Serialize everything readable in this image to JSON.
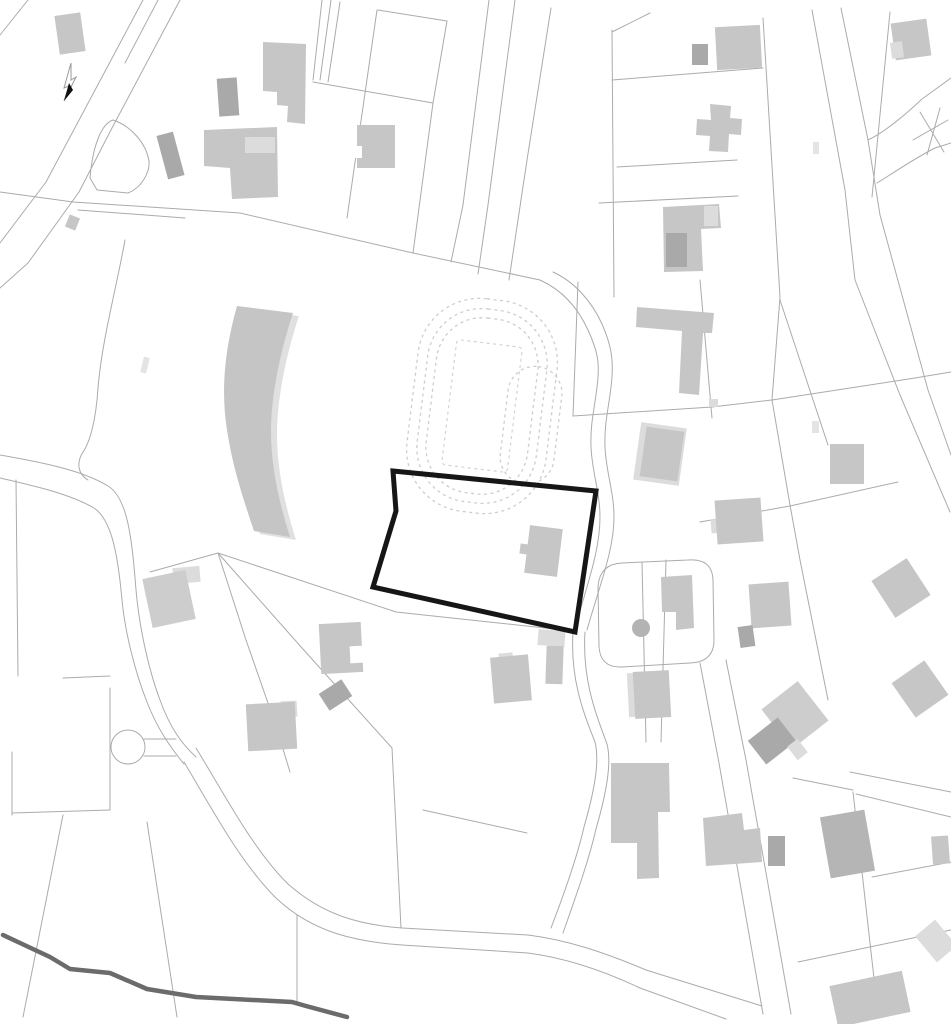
{
  "map": {
    "canvas": {
      "width": 951,
      "height": 1024,
      "background": "#ffffff"
    },
    "palette": {
      "mid": "#c6c6c6",
      "mid2": "#cdcdcd",
      "dim": "#b5b5b5",
      "dark": "#a9a9a9",
      "light": "#dcdcdc",
      "lighter": "#e4e4e4",
      "white": "#ffffff",
      "line": "#ababab",
      "track_dash": "#cdcdcd",
      "site_outline": "#161616",
      "stream": "#6b6b6b",
      "band_fill": "#c5c5c5",
      "band_halo": "#e0e0e0",
      "dot_fill": "#b3b3b3"
    },
    "site_boundary": {
      "points": "393,471 596,491 575,632 373,587 396,511",
      "stroke_width": 5
    },
    "stream": {
      "d": "M3,935 L50,957 L70,969 L110,973 L147,989 L196,997 L292,1002 L306,1006 L347,1017",
      "stroke_width": 4.5
    },
    "north_arrow": {
      "outline_points": "71,63 64,88 69,86 64,101 76,77 71,80",
      "blade_points": "64,101 69,83 73,90"
    },
    "pond": {
      "d": "M90,178 C93,142 103,123 113,120 C131,126 146,143 149,161 C150,173 141,188 128,193 L97,190 Z"
    },
    "culdesac": {
      "cx": 128,
      "cy": 747,
      "r": 17,
      "stubs": [
        "M144,739 L176,739",
        "M144,756 L176,756"
      ]
    },
    "dot": {
      "cx": 641,
      "cy": 628,
      "r": 9
    },
    "band": {
      "halo_dx": 6,
      "halo_dy": 3,
      "d": "M237,306 C224,352 221,392 227,430 C233,470 245,504 254,531 L290,537 C279,502 271,467 271,431 C271,396 280,352 293,313 Z"
    },
    "track": {
      "cx": 482,
      "cy": 406,
      "rot": 7,
      "rings": [
        {
          "w": 140,
          "h": 214,
          "rx": 62
        },
        {
          "w": 120,
          "h": 194,
          "rx": 54
        },
        {
          "w": 102,
          "h": 176,
          "rx": 46
        }
      ],
      "field": {
        "w": 66,
        "h": 126,
        "rx": 4
      },
      "appendix": {
        "x": 24,
        "y": -46,
        "w": 54,
        "h": 118,
        "rx": 27
      }
    },
    "lines": [
      "M143,0 L110,62 L78,122 L46,182 L0,243",
      "M180,0 L146,64 L112,128 L79,192 L28,263 L0,288",
      "M158,0 L125,63",
      "M28,0 L0,35",
      "M0,192 L73,202 L240,213 L413,253 L540,280",
      "M78,210 L185,218",
      "M540,280 C562,290 578,308 588,330 C598,352 599,362 598,377 C596,404 590,420 591,447 C592,472 600,492 600,517 C600,550 588,582 575,628",
      "M553,272 C575,282 592,302 602,324 C612,347 613,360 612,377 C610,404 604,420 605,447 C606,472 614,492 614,517 C614,550 600,584 587,630",
      "M573,632 C570,680 584,714 595,742 C600,762 594,792 584,827 C576,862 561,902 551,928",
      "M585,632 C582,680 596,714 607,744 C612,764 606,794 596,829 C588,864 573,904 563,933",
      "M489,0 L463,205 L451,262",
      "M515,0 L488,205 L478,274",
      "M551,8 L527,160 L509,280",
      "M313,82 L433,103",
      "M378,10 L447,21",
      "M377,10 L347,218",
      "M322,0 L313,80",
      "M331,0 L320,80",
      "M340,2 L328,82",
      "M433,103 L413,253",
      "M447,21 L440,62 L433,103",
      "M16,480 L18,676",
      "M12,752 L12,815",
      "M12,813 L110,810",
      "M110,688 L110,810",
      "M63,678 L110,676",
      "M0,455 C40,462 82,470 108,486 C128,498 132,540 136,590 C139,625 148,668 160,700 C170,728 182,744 196,757",
      "M0,478 C35,486 70,494 94,508 C112,520 118,556 122,600 C125,632 135,672 147,702 C157,728 170,747 184,764",
      "M196,748 C225,795 252,848 288,884 C324,916 362,925 402,928 L528,935 C568,940 606,953 646,970 L762,1006",
      "M184,762 C214,812 240,862 276,898 C314,934 360,942 402,945 L528,953 C566,958 602,970 640,988 L726,1019",
      "M700,663 L719,763 L763,1014",
      "M726,660 L746,760 L791,1014",
      "M598,586 Q600,564 622,563 L688,560 Q712,558 713,580 L714,640 Q714,662 690,663 L622,667 Q600,668 599,646 Z",
      "M642,562 L646,742",
      "M666,560 L661,742",
      "M612,30 L614,297",
      "M612,32 L650,13",
      "M612,80 L763,68",
      "M617,167 L737,160",
      "M599,203 L738,196",
      "M763,18 L780,297",
      "M700,280 L712,418",
      "M578,282 L573,416",
      "M573,416 L712,407 L772,400 L915,378",
      "M780,297 L772,400",
      "M915,378 L951,372",
      "M828,445 L780,300",
      "M772,400 L790,505 L800,560",
      "M700,522 L790,506 L898,482",
      "M812,10 L845,190 L855,280 L900,395 L950,512",
      "M841,8 L868,140 L880,215 L928,390 L951,455",
      "M868,140 C885,132 905,115 922,99 L951,78",
      "M877,183 C895,172 915,158 935,148 L951,143",
      "M920,112 L944,152",
      "M913,140 L948,120",
      "M927,155 L940,108",
      "M890,12 L872,197",
      "M850,772 L951,792",
      "M856,794 L951,817",
      "M793,778 L853,790",
      "M798,962 L951,930",
      "M853,792 L878,1014",
      "M872,877 L951,862",
      "M297,915 L297,1002",
      "M423,810 L527,833",
      "M63,815 L23,1017",
      "M147,822 L177,1017",
      "M125,240 C116,290 102,340 98,388 C96,420 90,442 83,452 C76,463 78,474 88,480",
      "M218,553 L396,612 L573,631",
      "M218,553 L302,648 L392,748",
      "M218,553 L246,640 L276,726 L290,772",
      "M218,553 L150,572",
      "M392,748 L401,928",
      "M800,560 L828,700"
    ],
    "buildings": [
      {
        "t": "rect",
        "x": 57,
        "y": 14,
        "w": 26,
        "h": 39,
        "r": -8,
        "f": "mid"
      },
      {
        "t": "rect",
        "x": 218,
        "y": 78,
        "w": 20,
        "h": 38,
        "r": -4,
        "f": "dark"
      },
      {
        "t": "poly",
        "p": "263,42 306,44 305,124 287,122 288,106 277,105 277,92 263,91",
        "f": "mid"
      },
      {
        "t": "poly",
        "p": "204,130 277,127 278,197 232,199 230,168 204,166",
        "f": "mid"
      },
      {
        "t": "rect",
        "x": 245,
        "y": 137,
        "w": 30,
        "h": 16,
        "r": 0,
        "f": "light"
      },
      {
        "t": "rect",
        "x": 162,
        "y": 133,
        "w": 17,
        "h": 45,
        "r": -15,
        "f": "dark"
      },
      {
        "t": "rect",
        "x": 67,
        "y": 216,
        "w": 11,
        "h": 13,
        "r": 22,
        "f": "mid"
      },
      {
        "t": "rect",
        "x": 357,
        "y": 125,
        "w": 38,
        "h": 43,
        "r": 0,
        "f": "mid"
      },
      {
        "t": "rect",
        "x": 354,
        "y": 146,
        "w": 8,
        "h": 12,
        "r": 0,
        "f": "white"
      },
      {
        "t": "rect",
        "x": 692,
        "y": 44,
        "w": 16,
        "h": 21,
        "r": 0,
        "f": "dark"
      },
      {
        "t": "rect",
        "x": 716,
        "y": 26,
        "w": 45,
        "h": 43,
        "r": -3,
        "f": "mid"
      },
      {
        "t": "poly",
        "p": "710,104 731,106 730,118 742,119 741,135 729,134 728,152 709,151 710,136 696,135 697,119 711,120",
        "f": "mid"
      },
      {
        "t": "poly",
        "p": "663,207 719,204 721,228 701,229 703,271 664,272",
        "f": "mid"
      },
      {
        "t": "rect",
        "x": 666,
        "y": 233,
        "w": 21,
        "h": 34,
        "r": 0,
        "f": "dark"
      },
      {
        "t": "rect",
        "x": 704,
        "y": 206,
        "w": 14,
        "h": 20,
        "r": 0,
        "f": "light"
      },
      {
        "t": "rect",
        "x": 893,
        "y": 21,
        "w": 36,
        "h": 37,
        "r": -8,
        "f": "mid"
      },
      {
        "t": "rect",
        "x": 891,
        "y": 42,
        "w": 12,
        "h": 16,
        "r": -8,
        "f": "light"
      },
      {
        "t": "poly",
        "p": "637,307 714,313 712,333 703,333 699,395 679,393 682,331 636,327",
        "f": "mid"
      },
      {
        "t": "rect",
        "x": 709,
        "y": 399,
        "w": 9,
        "h": 8,
        "r": 0,
        "f": "light"
      },
      {
        "t": "rect",
        "x": 637,
        "y": 425,
        "w": 46,
        "h": 58,
        "r": 8,
        "f": "light"
      },
      {
        "t": "rect",
        "x": 643,
        "y": 429,
        "w": 38,
        "h": 50,
        "r": 8,
        "f": "mid"
      },
      {
        "t": "rect",
        "x": 830,
        "y": 444,
        "w": 34,
        "h": 40,
        "r": 0,
        "f": "mid"
      },
      {
        "t": "rect",
        "x": 711,
        "y": 519,
        "w": 10,
        "h": 14,
        "r": -4,
        "f": "light"
      },
      {
        "t": "rect",
        "x": 716,
        "y": 499,
        "w": 46,
        "h": 44,
        "r": -4,
        "f": "mid"
      },
      {
        "t": "rect",
        "x": 880,
        "y": 566,
        "w": 42,
        "h": 44,
        "r": -33,
        "f": "mid"
      },
      {
        "t": "rect",
        "x": 900,
        "y": 668,
        "w": 40,
        "h": 42,
        "r": -35,
        "f": "mid"
      },
      {
        "t": "rect",
        "x": 527,
        "y": 527,
        "w": 33,
        "h": 48,
        "r": 7,
        "f": "mid"
      },
      {
        "t": "rect",
        "x": 520,
        "y": 544,
        "w": 8,
        "h": 10,
        "r": 7,
        "f": "mid"
      },
      {
        "t": "rect",
        "x": 538,
        "y": 630,
        "w": 27,
        "h": 16,
        "r": 4,
        "f": "light"
      },
      {
        "t": "rect",
        "x": 546,
        "y": 646,
        "w": 17,
        "h": 38,
        "r": 2,
        "f": "mid"
      },
      {
        "t": "poly",
        "p": "661,577 692,575 694,628 676,630 676,612 662,612",
        "f": "mid"
      },
      {
        "t": "rect",
        "x": 750,
        "y": 583,
        "w": 40,
        "h": 44,
        "r": -4,
        "f": "mid"
      },
      {
        "t": "rect",
        "x": 739,
        "y": 626,
        "w": 15,
        "h": 21,
        "r": -8,
        "f": "dark"
      },
      {
        "t": "rect",
        "x": 628,
        "y": 673,
        "w": 10,
        "h": 44,
        "r": -3,
        "f": "light"
      },
      {
        "t": "rect",
        "x": 634,
        "y": 671,
        "w": 36,
        "h": 47,
        "r": -3,
        "f": "mid"
      },
      {
        "t": "rect",
        "x": 772,
        "y": 690,
        "w": 46,
        "h": 50,
        "r": -38,
        "f": "mid2"
      },
      {
        "t": "rect",
        "x": 753,
        "y": 726,
        "w": 38,
        "h": 30,
        "r": -38,
        "f": "dark"
      },
      {
        "t": "rect",
        "x": 791,
        "y": 741,
        "w": 13,
        "h": 17,
        "r": -38,
        "f": "light"
      },
      {
        "t": "rect",
        "x": 173,
        "y": 567,
        "w": 27,
        "h": 16,
        "r": -5,
        "f": "light"
      },
      {
        "t": "rect",
        "x": 147,
        "y": 574,
        "w": 44,
        "h": 50,
        "r": -12,
        "f": "mid2"
      },
      {
        "t": "rect",
        "x": 320,
        "y": 623,
        "w": 42,
        "h": 50,
        "r": -3,
        "f": "mid"
      },
      {
        "t": "rect",
        "x": 350,
        "y": 646,
        "w": 13,
        "h": 17,
        "r": -3,
        "f": "white"
      },
      {
        "t": "rect",
        "x": 322,
        "y": 685,
        "w": 27,
        "h": 20,
        "r": -33,
        "f": "dark"
      },
      {
        "t": "rect",
        "x": 281,
        "y": 701,
        "w": 16,
        "h": 16,
        "r": -3,
        "f": "light"
      },
      {
        "t": "rect",
        "x": 247,
        "y": 703,
        "w": 49,
        "h": 47,
        "r": -3,
        "f": "mid"
      },
      {
        "t": "rect",
        "x": 499,
        "y": 653,
        "w": 14,
        "h": 12,
        "r": -5,
        "f": "light"
      },
      {
        "t": "rect",
        "x": 492,
        "y": 656,
        "w": 38,
        "h": 46,
        "r": -5,
        "f": "mid"
      },
      {
        "t": "poly",
        "p": "611,763 669,763 670,812 658,812 659,878 637,879 637,843 611,843",
        "f": "mid"
      },
      {
        "t": "poly",
        "p": "703,818 742,813 744,830 760,828 762,862 706,866",
        "f": "mid"
      },
      {
        "t": "rect",
        "x": 768,
        "y": 836,
        "w": 17,
        "h": 30,
        "r": 0,
        "f": "dark"
      },
      {
        "t": "rect",
        "x": 825,
        "y": 813,
        "w": 45,
        "h": 62,
        "r": -10,
        "f": "dim"
      },
      {
        "t": "rect",
        "x": 932,
        "y": 836,
        "w": 17,
        "h": 28,
        "r": -4,
        "f": "mid"
      },
      {
        "t": "rect",
        "x": 923,
        "y": 924,
        "w": 26,
        "h": 34,
        "r": -40,
        "f": "light"
      },
      {
        "t": "rect",
        "x": 833,
        "y": 978,
        "w": 74,
        "h": 42,
        "r": -12,
        "f": "mid"
      },
      {
        "t": "rect",
        "x": 812,
        "y": 421,
        "w": 7,
        "h": 12,
        "r": 0,
        "f": "lighter"
      },
      {
        "t": "rect",
        "x": 813,
        "y": 142,
        "w": 6,
        "h": 12,
        "r": 0,
        "f": "lighter"
      },
      {
        "t": "rect",
        "x": 142,
        "y": 357,
        "w": 6,
        "h": 16,
        "r": 14,
        "f": "lighter"
      }
    ]
  }
}
